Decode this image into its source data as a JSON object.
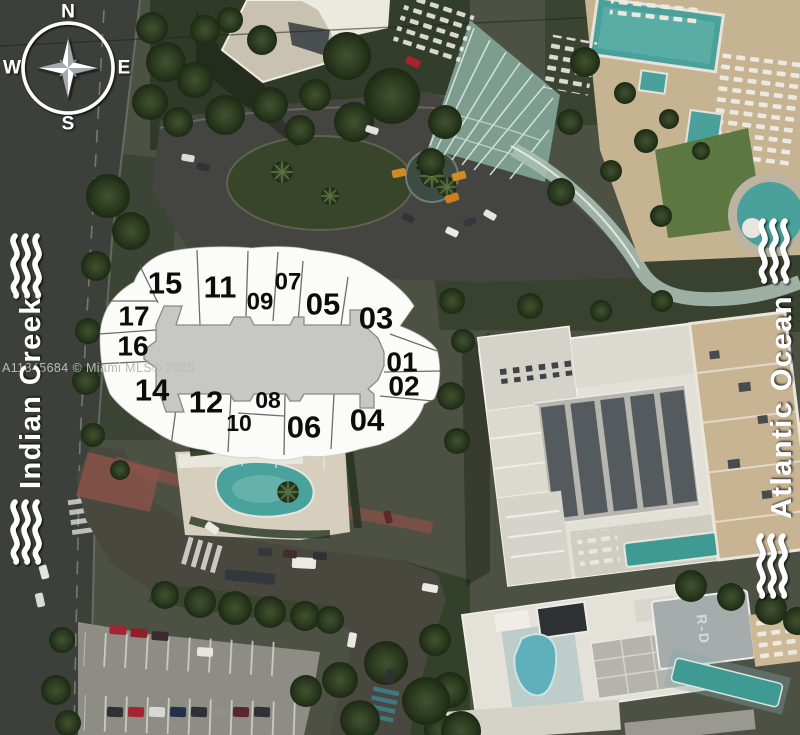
{
  "compass": {
    "north": "N",
    "east": "E",
    "south": "S",
    "west": "W"
  },
  "water_labels": {
    "left": "Indian Creek",
    "right": "Atlantic Ocean"
  },
  "watermark": "A11845684 © Miami MLS® 2025",
  "rooftop_marking": "R-D",
  "site_plan": {
    "units": [
      {
        "label": "15",
        "x": 165,
        "y": 283,
        "size": 31
      },
      {
        "label": "11",
        "x": 220,
        "y": 287,
        "size": 31
      },
      {
        "label": "07",
        "x": 288,
        "y": 282,
        "size": 24
      },
      {
        "label": "09",
        "x": 260,
        "y": 302,
        "size": 24
      },
      {
        "label": "05",
        "x": 323,
        "y": 304,
        "size": 31
      },
      {
        "label": "03",
        "x": 376,
        "y": 318,
        "size": 31
      },
      {
        "label": "17",
        "x": 134,
        "y": 316,
        "size": 28
      },
      {
        "label": "16",
        "x": 133,
        "y": 346,
        "size": 28
      },
      {
        "label": "01",
        "x": 402,
        "y": 362,
        "size": 28
      },
      {
        "label": "02",
        "x": 404,
        "y": 386,
        "size": 28
      },
      {
        "label": "14",
        "x": 152,
        "y": 390,
        "size": 31
      },
      {
        "label": "12",
        "x": 206,
        "y": 402,
        "size": 31
      },
      {
        "label": "10",
        "x": 239,
        "y": 423,
        "size": 23
      },
      {
        "label": "08",
        "x": 268,
        "y": 400,
        "size": 23
      },
      {
        "label": "06",
        "x": 304,
        "y": 427,
        "size": 31
      },
      {
        "label": "04",
        "x": 367,
        "y": 420,
        "size": 31
      }
    ]
  },
  "palette": {
    "overlay_white": "#fbfbf9",
    "corridor_gray": "#c7c7c4",
    "unit_number_black": "#0c0c0c",
    "pool_teal": "#4aa09a",
    "canopy_glass": "#8fa89b",
    "road_dark": "#45453e",
    "sand_tan": "#c6b392",
    "tree_green": "#2c3a22",
    "taxi_orange": "#d08a26",
    "car_red": "#a5242c",
    "label_white": "#ffffff"
  }
}
